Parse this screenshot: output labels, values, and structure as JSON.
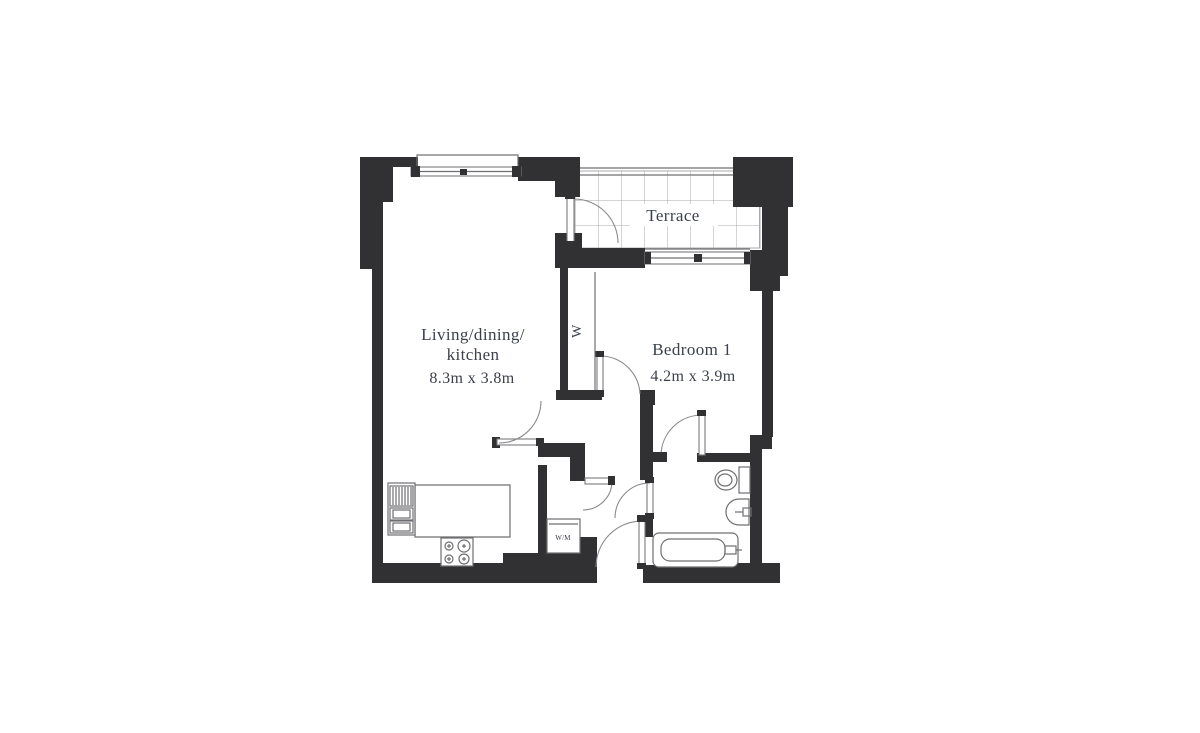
{
  "floor_plan": {
    "rooms": {
      "living": {
        "label_line1": "Living/dining/",
        "label_line2": "kitchen",
        "dimensions": "8.3m x 3.8m"
      },
      "bedroom": {
        "label": "Bedroom 1",
        "dimensions": "4.2m x 3.9m"
      },
      "terrace": {
        "label": "Terrace"
      }
    },
    "fixtures": {
      "wardrobe_label": "W",
      "washing_machine_label": "W/M"
    },
    "colors": {
      "wall": "#313134",
      "line": "#6f6f72",
      "grid": "#aaaaad",
      "text": "#3c414b",
      "background": "#ffffff"
    }
  }
}
